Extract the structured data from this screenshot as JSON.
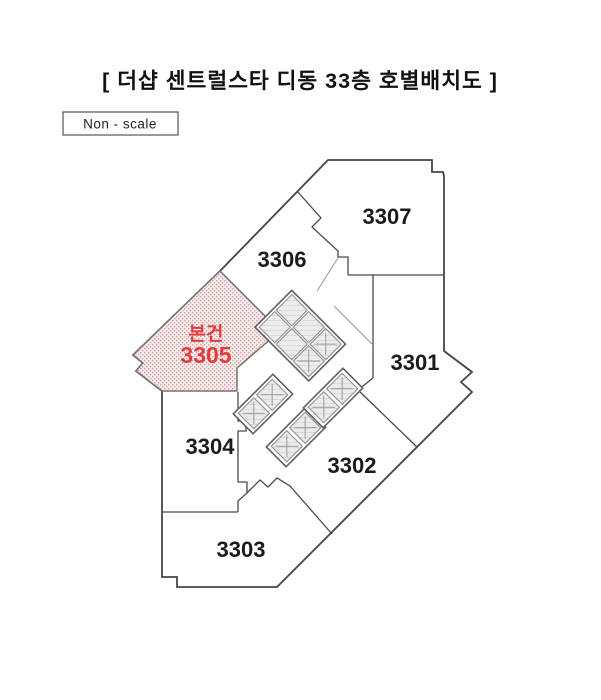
{
  "page": {
    "title": "[ 더샵 센트럴스타 디동 33층 호별배치도 ]",
    "scale_note": "Non - scale"
  },
  "floorplan": {
    "building_name": "더샵 센트럴스타",
    "dong": "디동",
    "floor": "33층",
    "drawing_type": "호별배치도",
    "units": [
      {
        "id": "3301",
        "label": "3301"
      },
      {
        "id": "3302",
        "label": "3302"
      },
      {
        "id": "3303",
        "label": "3303"
      },
      {
        "id": "3304",
        "label": "3304"
      },
      {
        "id": "3305",
        "label": "3305",
        "marker": "본건",
        "highlighted": true
      },
      {
        "id": "3306",
        "label": "3306"
      },
      {
        "id": "3307",
        "label": "3307"
      }
    ],
    "highlight": {
      "marker_label": "본건",
      "unit": "3305",
      "text_color": "#e23b3b",
      "fill_color": "#f8ecec",
      "dot_color": "#dba0a0"
    },
    "colors": {
      "wall": "#4a4a4a",
      "background": "#ffffff",
      "elevator_fill": "#ececec",
      "elevator_hatch": "#c9c9c9"
    }
  }
}
